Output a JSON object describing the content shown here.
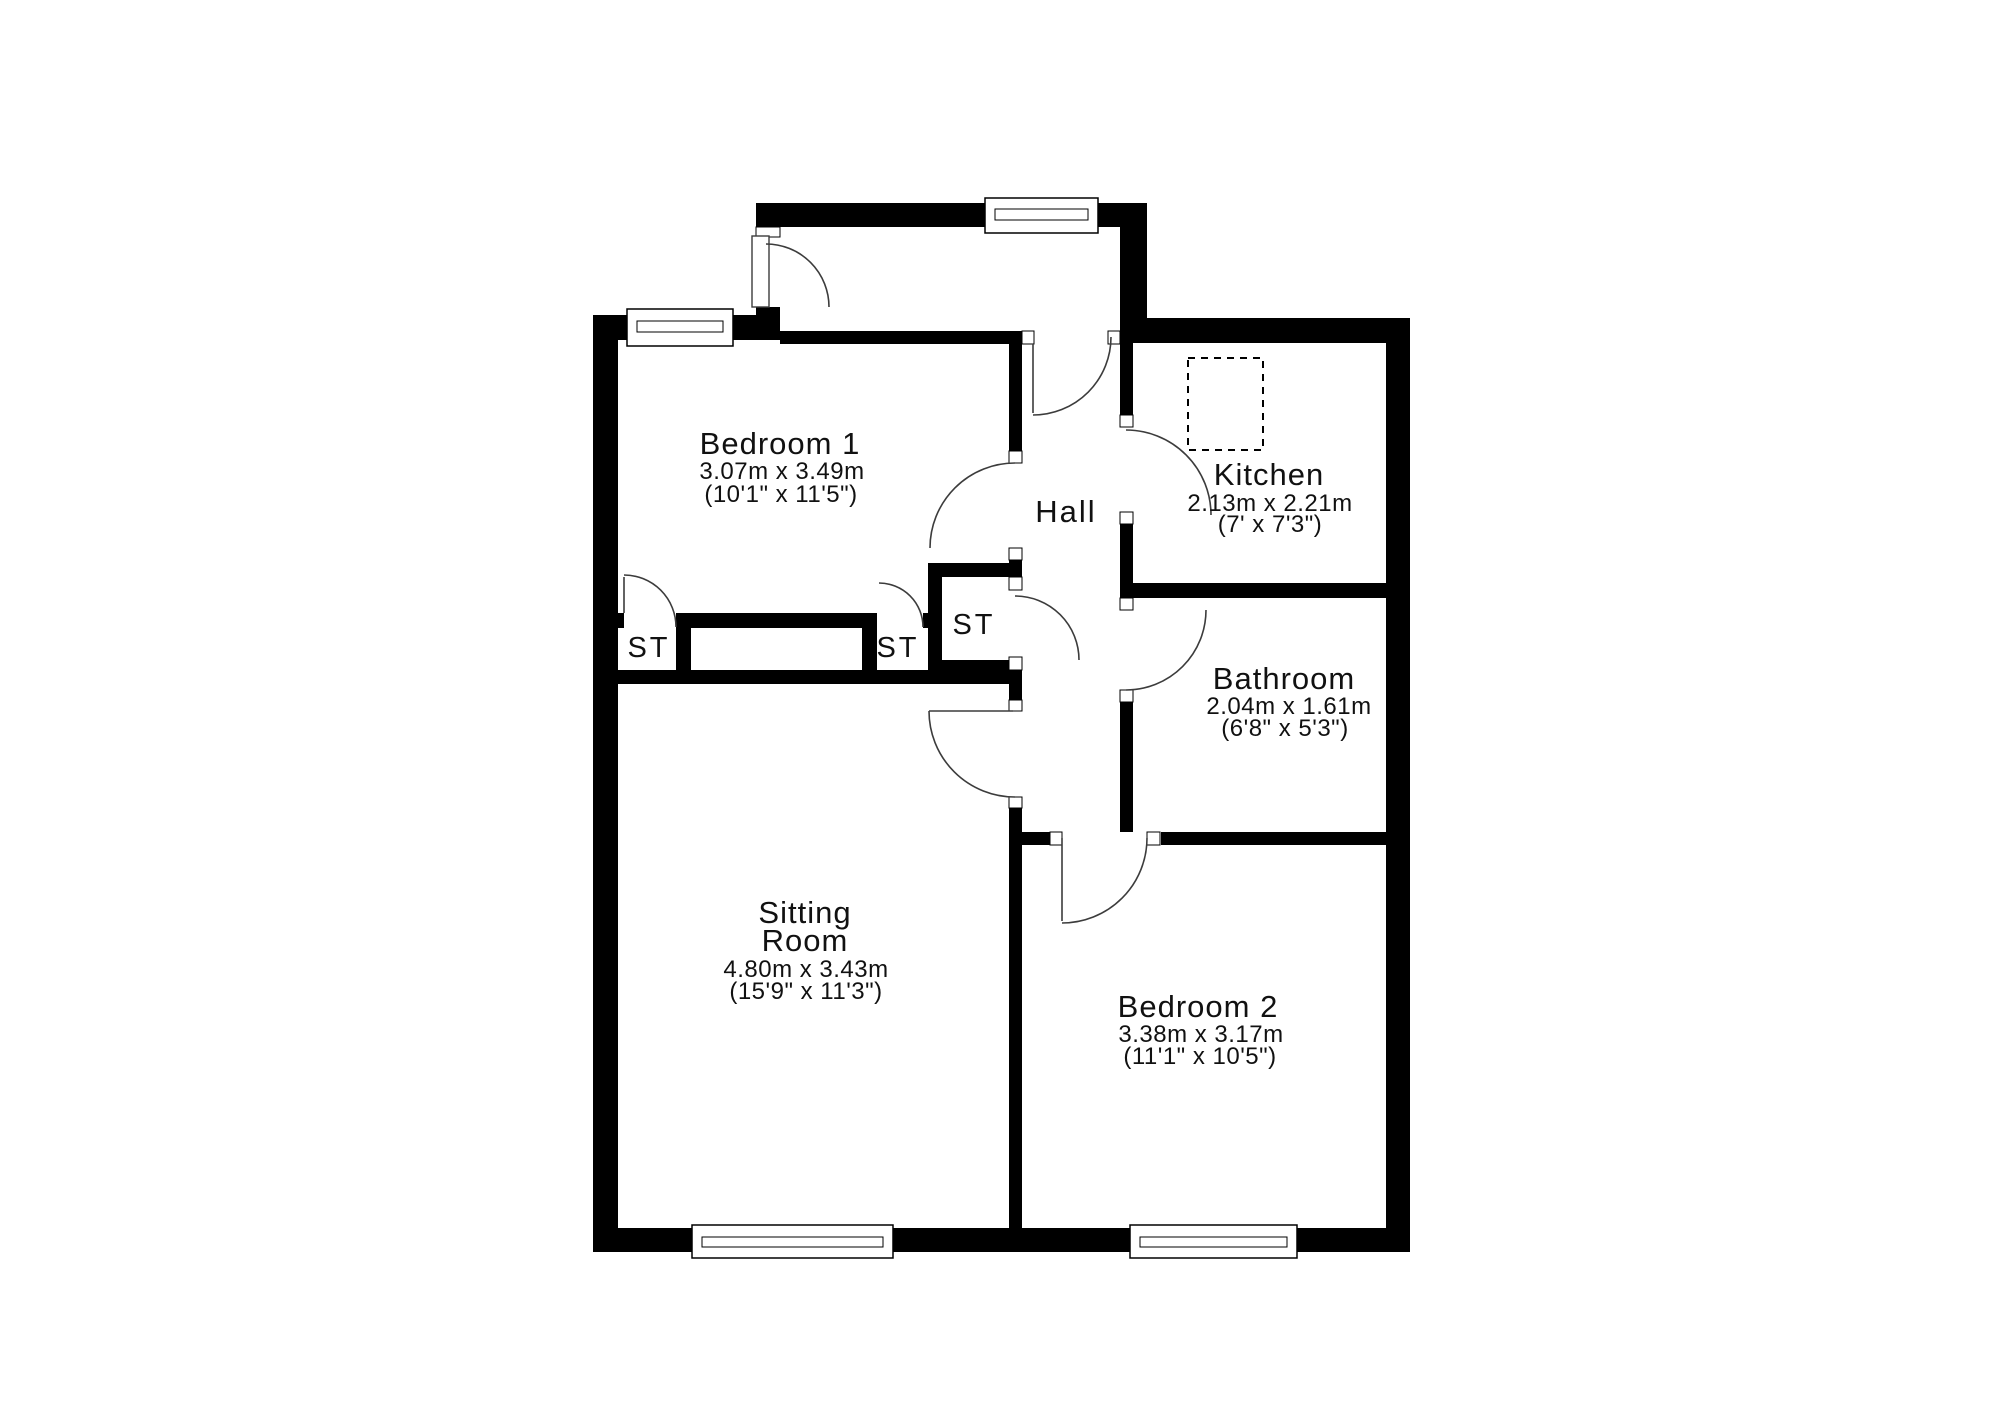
{
  "document": {
    "type": "floor-plan"
  },
  "colors": {
    "wall": "#000000",
    "background": "#ffffff",
    "door_arc": "#3c3c3c",
    "text": "#111111"
  },
  "rooms": {
    "bedroom1": {
      "name": "Bedroom 1",
      "dims_metric": "3.07m x 3.49m",
      "dims_imperial": "(10'1\" x 11'5\")"
    },
    "kitchen": {
      "name": "Kitchen",
      "dims_metric": "2.13m x 2.21m",
      "dims_imperial": "(7' x 7'3\")"
    },
    "hall": {
      "name": "Hall"
    },
    "bathroom": {
      "name": "Bathroom",
      "dims_metric": "2.04m x 1.61m",
      "dims_imperial": "(6'8\" x 5'3\")"
    },
    "sitting_room": {
      "name": "Sitting Room",
      "name_lines": [
        "Sitting",
        "Room"
      ],
      "dims_metric": "4.80m x 3.43m",
      "dims_imperial": "(15'9\" x 11'3\")"
    },
    "bedroom2": {
      "name": "Bedroom 2",
      "dims_metric": "3.38m x 3.17m",
      "dims_imperial": "(11'1\" x 10'5\")"
    }
  },
  "storage_closets": [
    {
      "label": "ST"
    },
    {
      "label": "ST"
    },
    {
      "label": "ST"
    }
  ]
}
